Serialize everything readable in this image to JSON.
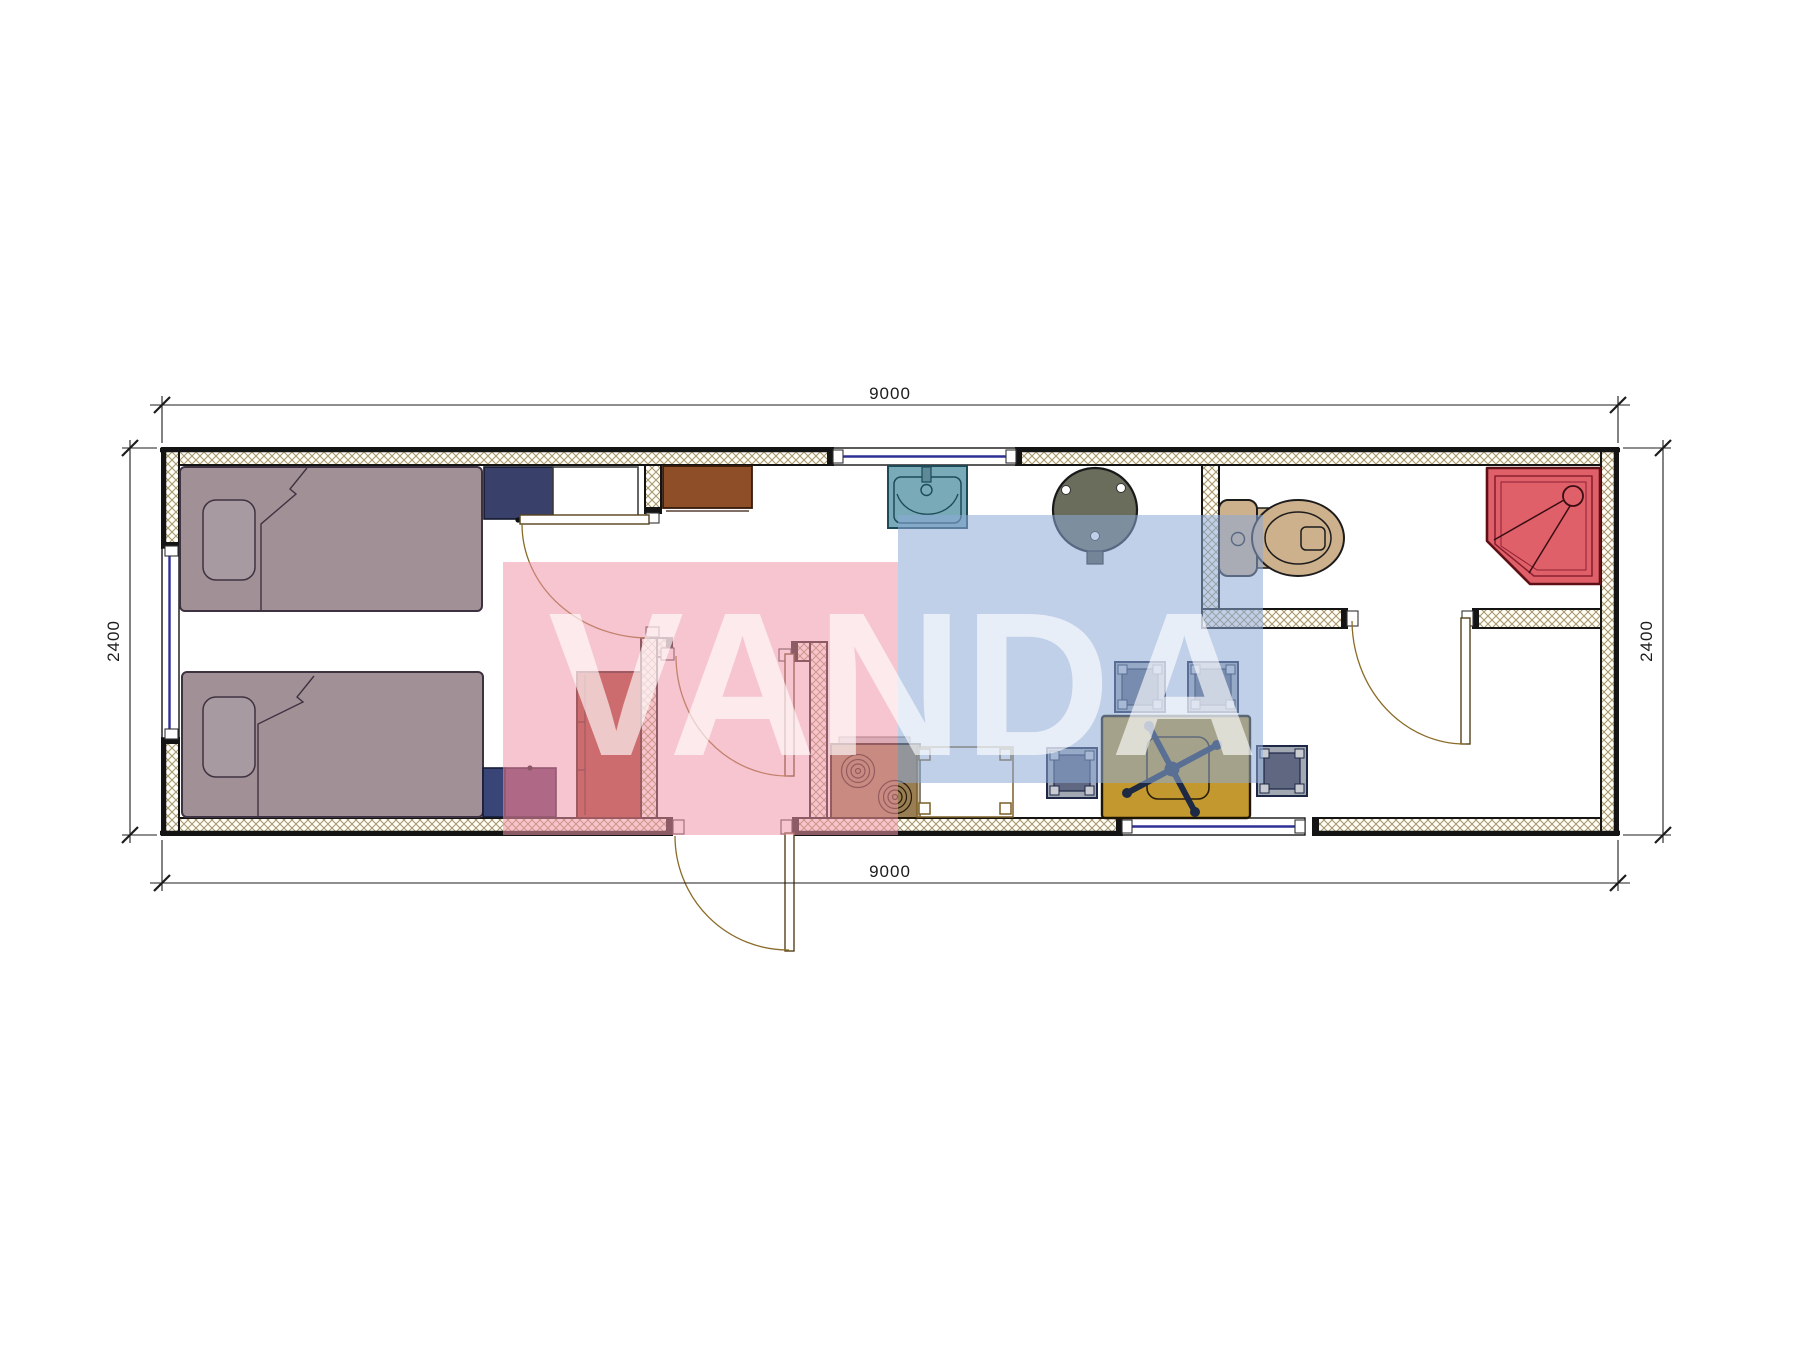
{
  "meta": {
    "type": "architectural-floor-plan",
    "units": "mm",
    "background": "#ffffff"
  },
  "watermark": {
    "text": "VANDA",
    "pink_block_color": "#f0a0b4",
    "blue_block_color": "#8caad4",
    "letter_color": "#ffffff"
  },
  "dimensions": {
    "top": "9000",
    "bottom": "9000",
    "left": "2400",
    "right": "2400"
  },
  "plan": {
    "wall_outline_color": "#141414",
    "wall_hatch_color": "#a4946a",
    "window_glazing_color": "#2f3096",
    "door_arc_color": "#8a6b28",
    "rooms": [
      "bedroom",
      "entry-hall",
      "kitchen-living",
      "bathroom"
    ],
    "windows": [
      "left-wall-window",
      "top-wall-window",
      "bottom-wall-window"
    ],
    "doors": [
      "bedroom-door",
      "hall-door",
      "entry-door",
      "bathroom-door"
    ],
    "furniture": [
      {
        "name": "bed-top",
        "color": "#a29097"
      },
      {
        "name": "bed-bottom",
        "color": "#a29097"
      },
      {
        "name": "nightstand-navy",
        "color": "#39416b"
      },
      {
        "name": "cabinet-white",
        "color": "#ffffff"
      },
      {
        "name": "cabinet-brown",
        "color": "#8d4e28"
      },
      {
        "name": "box-blue",
        "color": "#3a4577"
      },
      {
        "name": "box-purple",
        "color": "#63315f"
      },
      {
        "name": "wardrobe-brick",
        "color": "#a33b28"
      },
      {
        "name": "sink",
        "color": "#78aab8"
      },
      {
        "name": "water-heater",
        "color": "#6b6d5c"
      },
      {
        "name": "stove",
        "color": "#9a7e53"
      },
      {
        "name": "kitchen-counter",
        "color": "#ffffff"
      },
      {
        "name": "stool",
        "count": 4,
        "color": "#9aa2ac"
      },
      {
        "name": "dining-table",
        "color": "#c3992f"
      },
      {
        "name": "office-chair",
        "color": "#1e2944"
      },
      {
        "name": "toilet",
        "color": "#cdb08c"
      },
      {
        "name": "shower",
        "color": "#e0606a"
      }
    ]
  }
}
